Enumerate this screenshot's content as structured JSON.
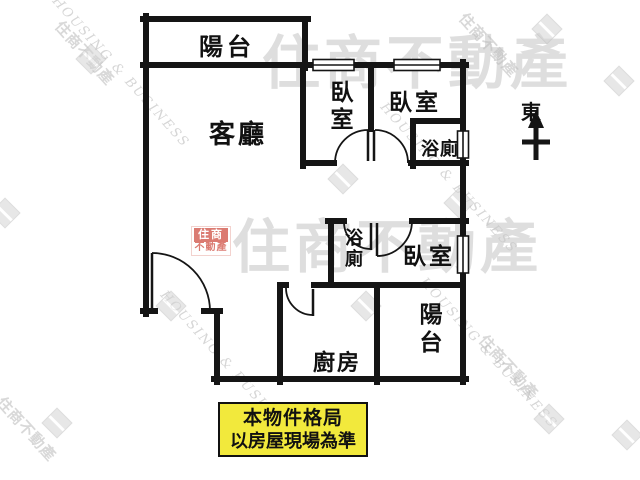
{
  "rooms": {
    "balcony_top": "陽台",
    "living": "客廳",
    "bedroom1": "臥室",
    "bedroom2": "臥室",
    "bath1": "浴廁",
    "bath2": "浴廁",
    "bedroom3": "臥室",
    "kitchen": "廚房",
    "balcony_bottom": "陽台"
  },
  "compass": {
    "label": "東"
  },
  "disclaimer": {
    "line1": "本物件格局",
    "line2": "以房屋現場為準"
  },
  "watermark": {
    "brand_zh": "住商不動產",
    "brand_en": "HOUSING & BUSINESS",
    "stamp_top": "住商",
    "stamp_bottom": "不動產"
  },
  "colors": {
    "wall": "#151515",
    "disclaimer_bg": "#f2e93c",
    "stamp_red": "#cf4f44",
    "watermark_gray": "#bfbfbf"
  }
}
